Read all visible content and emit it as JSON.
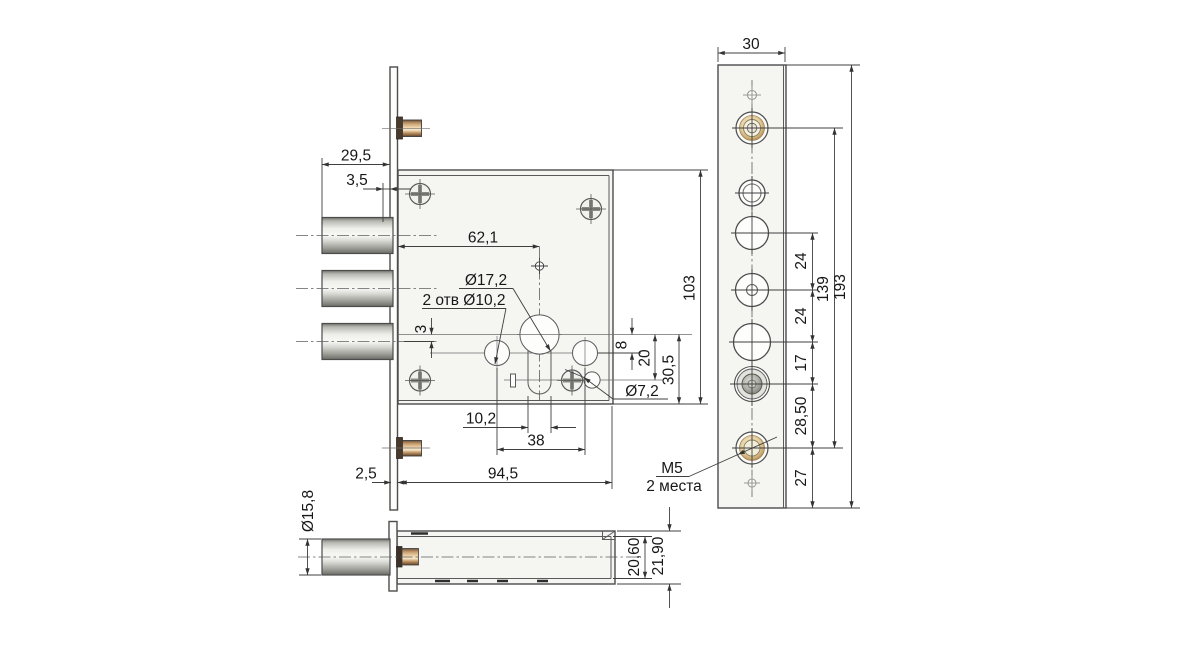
{
  "drawing": {
    "background": "#ffffff",
    "colors": {
      "line": "#4c4c4c",
      "body_fill": "#f5f5f2",
      "metal": "#c9c9c6",
      "brass": "#d9bd8c",
      "dim_text": "#171717"
    },
    "views": {
      "front": {
        "description": "lock body front view with three bolts, euro-cylinder keyhole and screws",
        "dimensions": [
          "29,5",
          "3,5",
          "62,1",
          "3",
          "8",
          "20",
          "30,5",
          "103",
          "10,2",
          "38",
          "2,5",
          "94,5"
        ],
        "callouts": [
          "Ø17,2",
          "2 отв Ø10,2",
          "Ø7,2"
        ]
      },
      "faceplate": {
        "description": "faceplate (forend) front view with hole pattern",
        "dimensions": [
          "30",
          "24",
          "24",
          "17",
          "28,50",
          "27",
          "139",
          "193"
        ],
        "callouts": [
          "М5",
          "2 места"
        ]
      },
      "side": {
        "description": "lock bottom/side view with bolt",
        "dimensions": [
          "Ø15,8",
          "2,5",
          "94,5",
          "20,60",
          "21,90"
        ]
      }
    }
  },
  "labels": {
    "d29_5": "29,5",
    "d3_5": "3,5",
    "d62_1": "62,1",
    "dia17_2": "Ø17,2",
    "note10_2": "2 отв Ø10,2",
    "d3": "3",
    "d8": "8",
    "d20": "20",
    "d30_5": "30,5",
    "d103": "103",
    "dia7_2": "Ø7,2",
    "d10_2": "10,2",
    "d38": "38",
    "d2_5": "2,5",
    "d94_5": "94,5",
    "m5": "М5",
    "m5_places": "2 места",
    "dia15_8": "Ø15,8",
    "d20_60": "20,60",
    "d21_90": "21,90",
    "d30": "30",
    "d24a": "24",
    "d24b": "24",
    "d139": "139",
    "d17": "17",
    "d28_50": "28,50",
    "d27": "27",
    "d193": "193"
  }
}
